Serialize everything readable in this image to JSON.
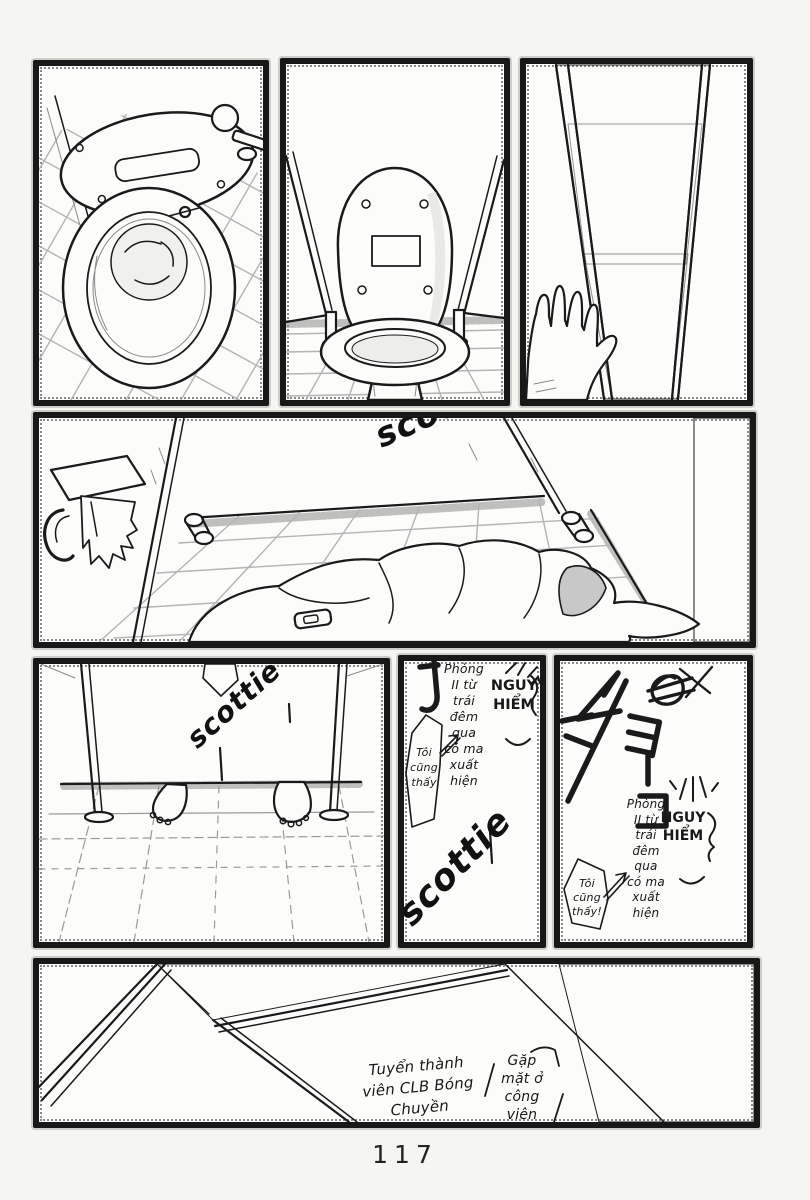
{
  "page": {
    "number": "117"
  },
  "colors": {
    "ink": "#1a1a1a",
    "paper": "#f5f5f1",
    "panel_white": "#fcfcfa",
    "tone_gray": "#e9e9e6"
  },
  "graffiti": {
    "stall_wall_partial": "scott",
    "stall_door_tag": "scottie",
    "wall_tag_large": "scottie",
    "katakana_tag": "ショーコ"
  },
  "wall_writing": {
    "warning": "Phòng\nII từ\ntrái\nđêm\nqua\ncó ma\nxuất\nhiện",
    "danger": "NGUY\nHIỂM",
    "witness": "Tôi\ncũng\nthấy",
    "witness_excl": "Tôi\ncũng\nthấy!"
  },
  "notes": {
    "recruit": "Tuyển thành\nviên CLB Bóng\nChuyền",
    "meet": "Gặp\nmặt ở\ncông\nviên"
  }
}
